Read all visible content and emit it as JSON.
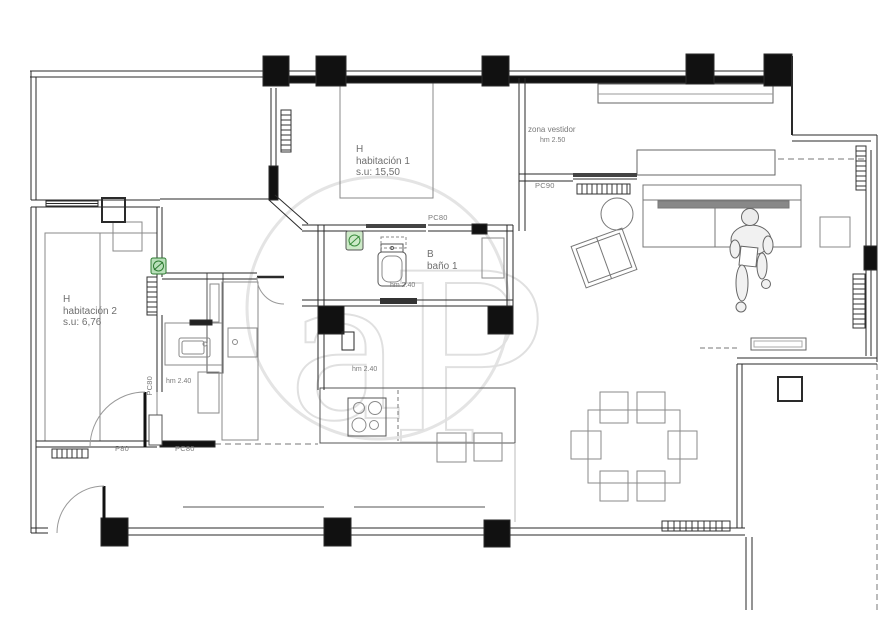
{
  "watermark": {
    "letter_a": "a",
    "letter_p": "P",
    "color": "#e0e0e0"
  },
  "rooms": {
    "bedroom1": {
      "tag": "H",
      "name": "habitación 1",
      "area": "s.u: 15,50"
    },
    "bedroom2": {
      "tag": "H",
      "name": "habitación 2",
      "area": "s.u: 6,76"
    },
    "bathroom1": {
      "tag": "B",
      "name": "baño 1",
      "ceiling_height": "hm 2.40"
    },
    "dressing_area": {
      "name": "zona vestidor",
      "ceiling_height": "hm 2.50"
    },
    "kitchen": {
      "ceiling_height": "hm 2.40"
    },
    "hall": {
      "ceiling_height": "hm 2.40"
    }
  },
  "door_labels": {
    "pc90": "PC90",
    "pc80_bathroom": "PC80",
    "pc80_hall_vertical": "PC80",
    "pc80_hall_bottom": "PC80",
    "p80": "P80"
  },
  "colors": {
    "walls": "#1c1c1c",
    "furniture": "#8a8a8a",
    "labels": "#7a7a7a",
    "symbol_green_fill": "#b9e0ba",
    "symbol_green_stroke": "#2e7d32"
  }
}
